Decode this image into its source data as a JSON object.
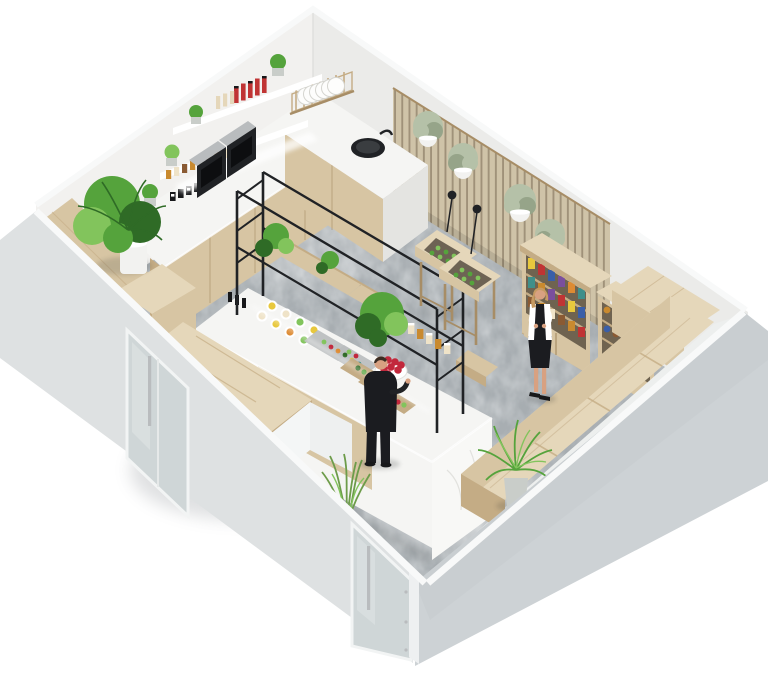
{
  "meta": {
    "title": "3D isometric cutaway render of an organic grocery cafe interior",
    "width_px": 768,
    "height_px": 675
  },
  "palette": {
    "bg": "#ffffff",
    "wall_in": "#f2f1ef",
    "wall_in2": "#ebebe9",
    "wall_edge": "#f8f9f9",
    "wall_out_left": "#dee1e2",
    "wall_out_right": "#cdd2d5",
    "floor": "#a7adb1",
    "floor_light": "#c2c6c8",
    "floor_dark": "#8d9398",
    "wood": "#d7c5a3",
    "wood_side": "#c4ac85",
    "wood_dark": "#a78d66",
    "wood_light": "#e5d7ba",
    "slat": "#cfc3a8",
    "slat_gap": "#9f9179",
    "marble": "#f5f5f3",
    "marble_shade": "#e4e4e1",
    "metal": "#202225",
    "steel": "#b9bcbe",
    "glass": "#cfd6d7",
    "plant": "#55a33c",
    "plant_dark": "#2f6b26",
    "plant_light": "#82c45c",
    "sage": "#b5c1a8",
    "sage_dark": "#96a489",
    "pot_white": "#f2f2f0",
    "pot_gray": "#c9cdc9",
    "grass": "#6d9c4a",
    "skin": "#d8a181",
    "hair": "#c69a62",
    "suit": "#1b1c20",
    "ink": "#17181a",
    "red": "#c03434",
    "apple": "#c2283c",
    "yellow": "#e8c83d",
    "orange": "#dd8b33",
    "cream": "#efe3c8",
    "teal": "#3f8f8a",
    "blue": "#3a5fa8",
    "purple": "#7a4f9e",
    "brown": "#8a5a33",
    "amber": "#c98a2f",
    "white": "#ffffff",
    "recess": "#6f6350"
  },
  "scene": {
    "objects": [
      {
        "id": "room-shell",
        "label": "white cutaway room shell"
      },
      {
        "id": "concrete-floor",
        "label": "polished concrete floor"
      },
      {
        "id": "glass-door-left",
        "label": "glass door in left front wall"
      },
      {
        "id": "glass-door-front",
        "label": "glass door at front corner"
      },
      {
        "id": "kitchen-counter",
        "label": "wood kitchen counter with marble top"
      },
      {
        "id": "spice-shelves",
        "label": "wall shelves with bottles, grinders and spice jars"
      },
      {
        "id": "appliances",
        "label": "two countertop ovens"
      },
      {
        "id": "dish-rack",
        "label": "wooden dish rack with plates"
      },
      {
        "id": "sink",
        "label": "round black sink with faucet"
      },
      {
        "id": "slat-wall",
        "label": "vertical wood slat accent wall"
      },
      {
        "id": "hanging-planters",
        "label": "hanging white planters with sage-green plants"
      },
      {
        "id": "herb-tables",
        "label": "two high tables with potted herbs and black lamps"
      },
      {
        "id": "grocery-shelves",
        "label": "wooden shelving units with packaged goods"
      },
      {
        "id": "wall-bench",
        "label": "built-in wood bench along right wall"
      },
      {
        "id": "island",
        "label": "marble salad-bar island with fresh food"
      },
      {
        "id": "overhead-rack",
        "label": "black metal overhead rack with planters and jars"
      },
      {
        "id": "apples",
        "label": "bowl of red apples"
      },
      {
        "id": "palm-plant",
        "label": "potted palm plant"
      },
      {
        "id": "spider-plant",
        "label": "potted spider plant"
      },
      {
        "id": "grass-plant",
        "label": "ornamental grass clump"
      },
      {
        "id": "man-customer",
        "label": "man in dark suit at the island"
      },
      {
        "id": "woman-staff",
        "label": "waitress near the grocery shelves"
      }
    ]
  }
}
